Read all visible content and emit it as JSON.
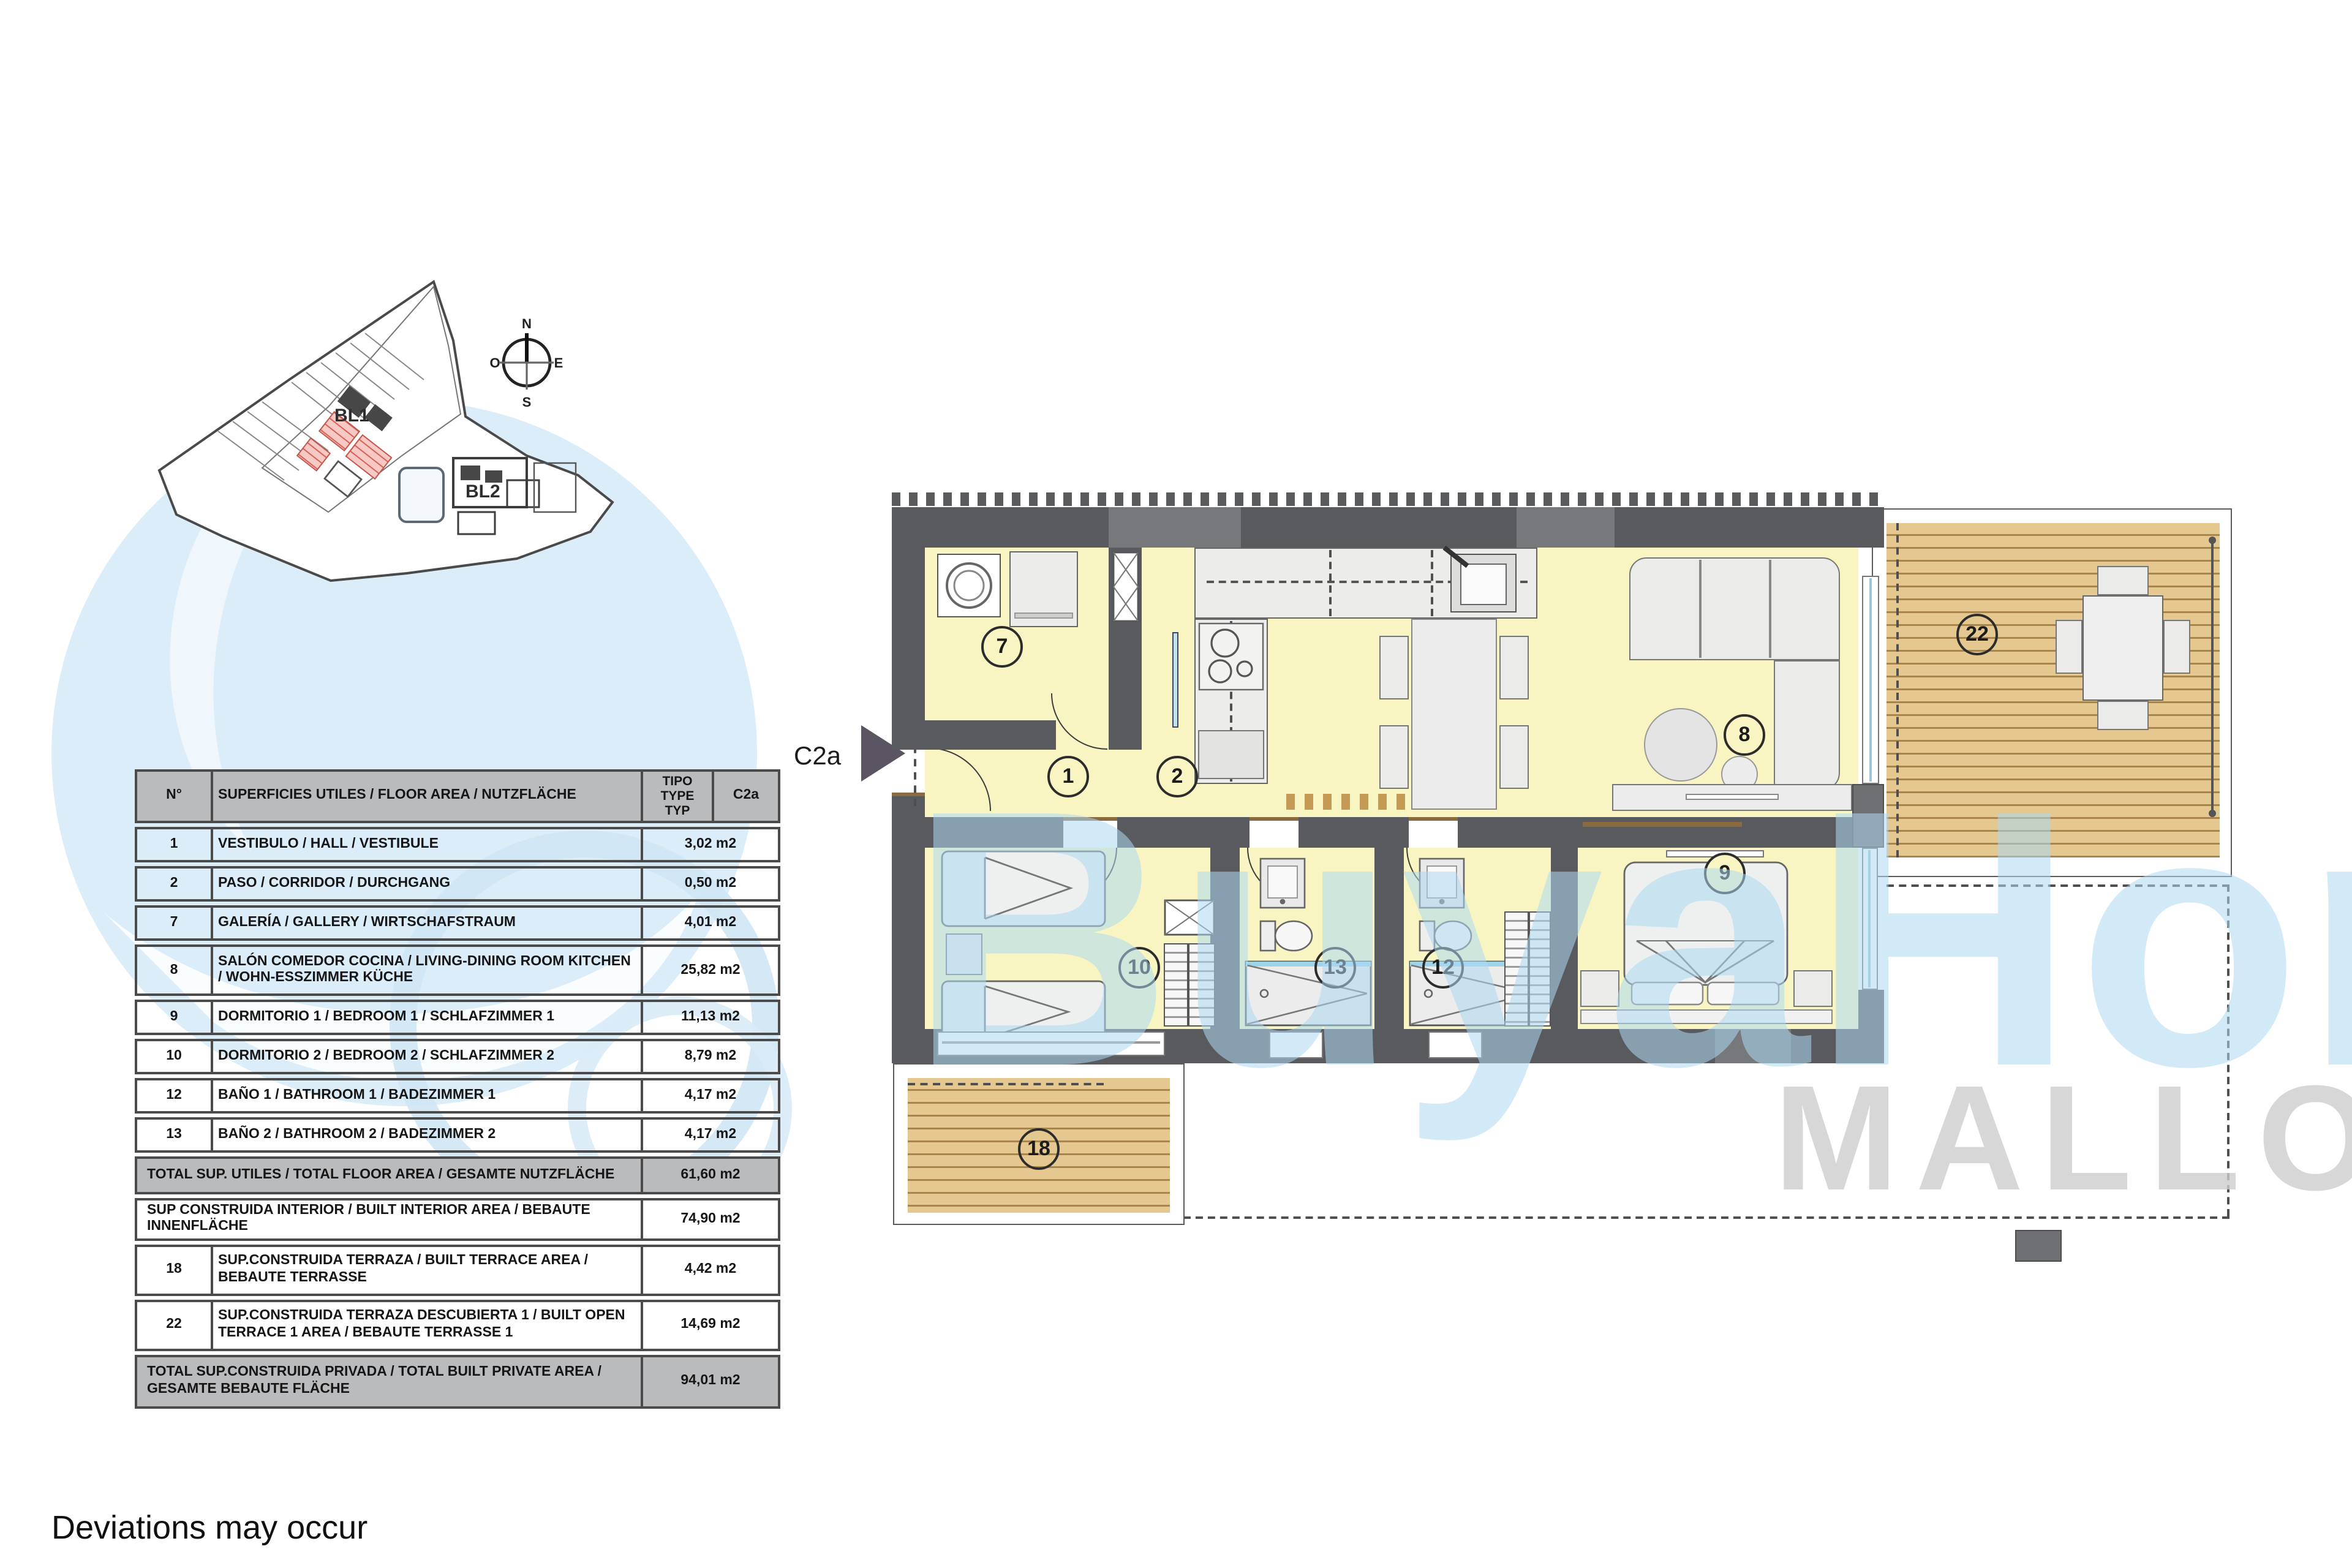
{
  "page": {
    "disclaimer": "Deviations may occur"
  },
  "unit_label": "C2a",
  "compass": {
    "n": "N",
    "e": "E",
    "s": "S",
    "o": "O"
  },
  "siteplan": {
    "bl1": "BL1",
    "bl2": "BL2"
  },
  "watermark": {
    "brand": "BuyaHome",
    "region": "MALLORCA"
  },
  "plan": {
    "bubbles": [
      "7",
      "1",
      "2",
      "8",
      "9",
      "10",
      "13",
      "12",
      "22",
      "18"
    ]
  },
  "table": {
    "header": {
      "no": "N°",
      "label": "SUPERFICIES UTILES / FLOOR AREA / NUTZFLÄCHE",
      "tipo": "TIPO TYPE TYP",
      "c2a": "C2a"
    },
    "rows": [
      {
        "type": "data",
        "no": "1",
        "label": "VESTIBULO / HALL  / VESTIBULE",
        "value": "3,02 m2"
      },
      {
        "type": "data",
        "no": "2",
        "label": "PASO  / CORRIDOR / DURCHGANG",
        "value": "0,50 m2"
      },
      {
        "type": "data",
        "no": "7",
        "label": "GALERÍA / GALLERY / WIRTSCHAFSTRAUM",
        "value": "4,01 m2"
      },
      {
        "type": "data2",
        "no": "8",
        "label": "SALÓN COMEDOR COCINA / LIVING-DINING ROOM KITCHEN / WOHN-ESSZIMMER KÜCHE",
        "value": "25,82 m2"
      },
      {
        "type": "data",
        "no": "9",
        "label": "DORMITORIO 1 / BEDROOM 1 / SCHLAFZIMMER 1",
        "value": "11,13 m2"
      },
      {
        "type": "data",
        "no": "10",
        "label": "DORMITORIO 2 / BEDROOM 2 / SCHLAFZIMMER 2",
        "value": "8,79 m2"
      },
      {
        "type": "data",
        "no": "12",
        "label": "BAÑO 1 / BATHROOM 1 / BADEZIMMER 1",
        "value": "4,17 m2"
      },
      {
        "type": "data",
        "no": "13",
        "label": "BAÑO 2 / BATHROOM 2 / BADEZIMMER 2",
        "value": "4,17 m2"
      },
      {
        "type": "total",
        "no": "",
        "label": "TOTAL SUP. UTILES / TOTAL FLOOR AREA / GESAMTE NUTZFLÄCHE",
        "value": "61,60 m2"
      },
      {
        "type": "sub",
        "no": "",
        "label": "SUP CONSTRUIDA INTERIOR / BUILT INTERIOR AREA / BEBAUTE INNENFLÄCHE",
        "value": "74,90 m2"
      },
      {
        "type": "data2",
        "no": "18",
        "label": "SUP.CONSTRUIDA TERRAZA / BUILT TERRACE AREA / BEBAUTE TERRASSE",
        "value": "4,42 m2"
      },
      {
        "type": "data2",
        "no": "22",
        "label": "SUP.CONSTRUIDA TERRAZA DESCUBIERTA 1 / BUILT OPEN TERRACE  1 AREA / BEBAUTE TERRASSE 1",
        "value": "14,69 m2"
      },
      {
        "type": "total2",
        "no": "",
        "label": "TOTAL SUP.CONSTRUIDA PRIVADA / TOTAL  BUILT PRIVATE AREA / GESAMTE BEBAUTE FLÄCHE",
        "value": "94,01 m2"
      }
    ]
  }
}
